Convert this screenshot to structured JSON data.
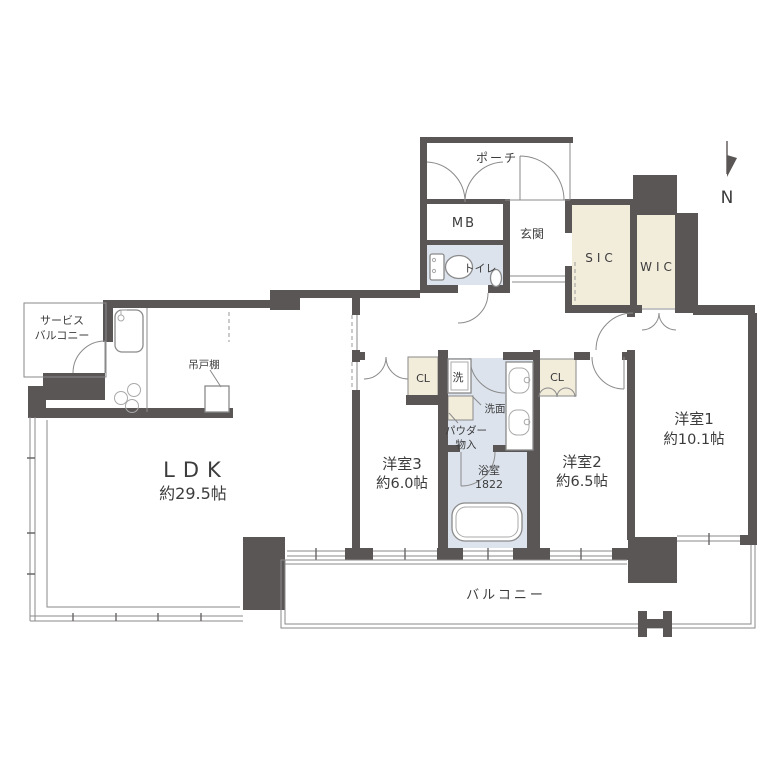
{
  "colors": {
    "wall": "#5a5656",
    "cream": "#f2ecdb",
    "blue": "#dce3ed",
    "line": "#8a8a8a",
    "text": "#3c3c3c",
    "bg": "#ffffff"
  },
  "compass": {
    "north_label": "N"
  },
  "labels": {
    "porch": "ポーチ",
    "meter_box": "MB",
    "entrance": "玄関",
    "toilet": "トイレ",
    "shoes_in_closet": "SIC",
    "walk_in_closet": "WIC",
    "service_balcony_line1": "サービス",
    "service_balcony_line2": "バルコニー",
    "hanging_cupboard": "吊戸棚",
    "ldk_name": "LDK",
    "ldk_size": "約29.5帖",
    "bedroom3_name": "洋室3",
    "bedroom3_size": "約6.0帖",
    "bedroom2_name": "洋室2",
    "bedroom2_size": "約6.5帖",
    "bedroom1_name": "洋室1",
    "bedroom1_size": "約10.1帖",
    "bathroom_name": "浴室",
    "bathroom_size": "1822",
    "washer": "洗",
    "vanity": "洗面",
    "powder_line1": "パウダー",
    "powder_line2": "物入",
    "closet_bedroom3": "CL",
    "closet_bedroom2": "CL",
    "balcony": "バルコニー"
  }
}
